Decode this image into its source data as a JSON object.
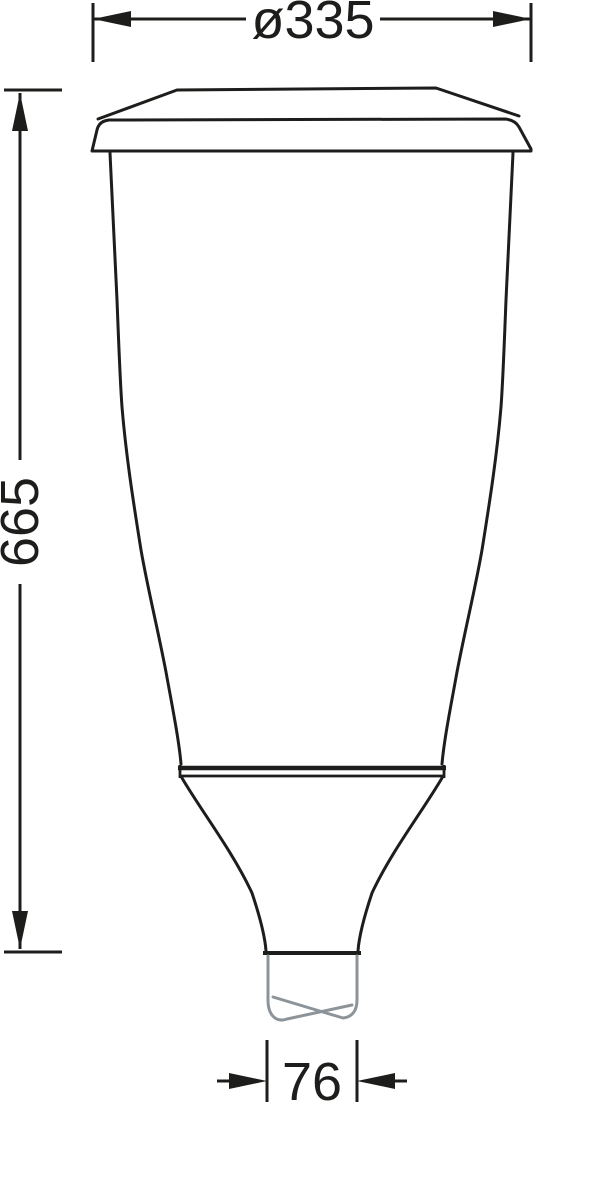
{
  "drawing": {
    "type": "technical-dimension-drawing",
    "subject": "post-top luminaire side profile with pole spigot",
    "colors": {
      "outline": "#1d1d1b",
      "pole_break": "#8d9499",
      "background": "#ffffff"
    },
    "dimensions": {
      "diameter": {
        "label": "ø335"
      },
      "height": {
        "label": "665"
      },
      "spigot": {
        "label": "76"
      }
    }
  }
}
